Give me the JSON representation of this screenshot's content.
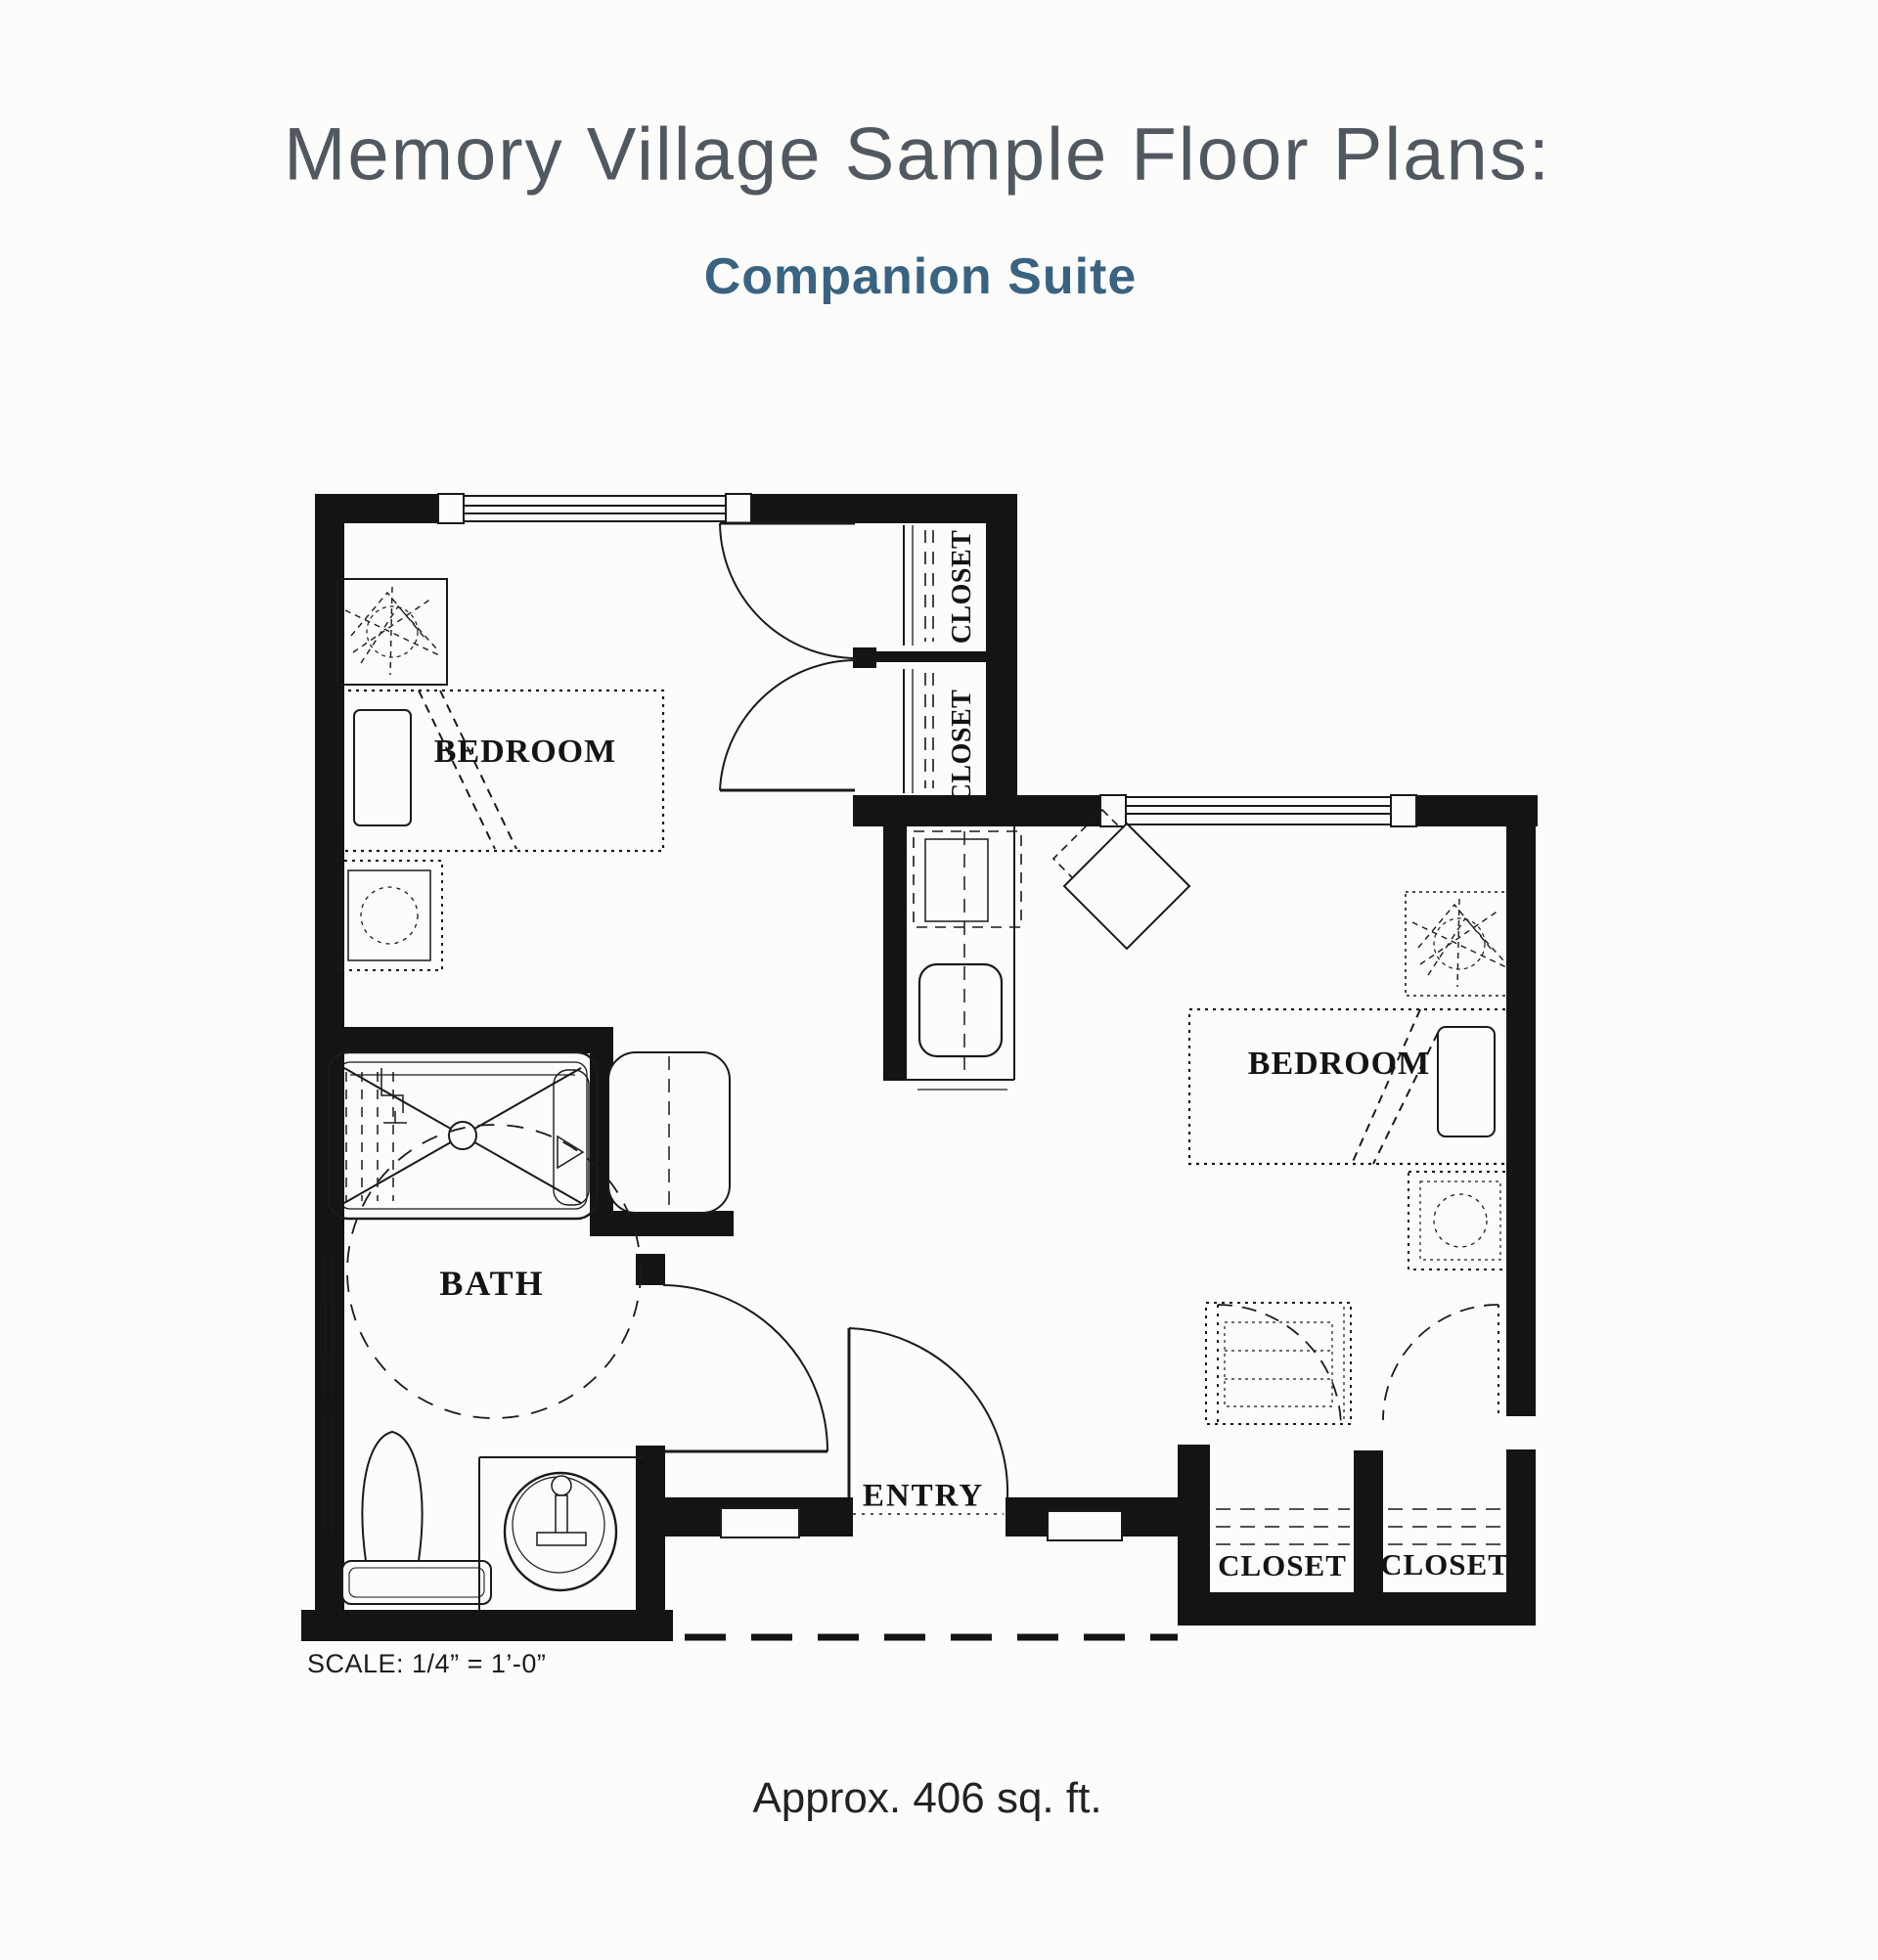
{
  "header": {
    "title": "Memory Village Sample Floor Plans:",
    "subtitle": "Companion Suite"
  },
  "floor_plan": {
    "scale_note": "SCALE: 1/4” = 1’-0”",
    "area_note": "Approx. 406 sq. ft.",
    "rooms": [
      {
        "id": "bedroom-1",
        "label": "BEDROOM"
      },
      {
        "id": "bedroom-2",
        "label": "BEDROOM"
      },
      {
        "id": "bath",
        "label": "BATH"
      },
      {
        "id": "entry",
        "label": "ENTRY"
      },
      {
        "id": "closet-top-upper",
        "label": "CLOSET"
      },
      {
        "id": "closet-top-lower",
        "label": "CLOSET"
      },
      {
        "id": "closet-bottom-left",
        "label": "CLOSET"
      },
      {
        "id": "closet-bottom-right",
        "label": "CLOSET"
      }
    ],
    "colors": {
      "wall": "#141414",
      "line": "#1a1a1a",
      "paper": "#fcfcfb",
      "title": "#51585f",
      "subtitle": "#3a6381"
    }
  }
}
